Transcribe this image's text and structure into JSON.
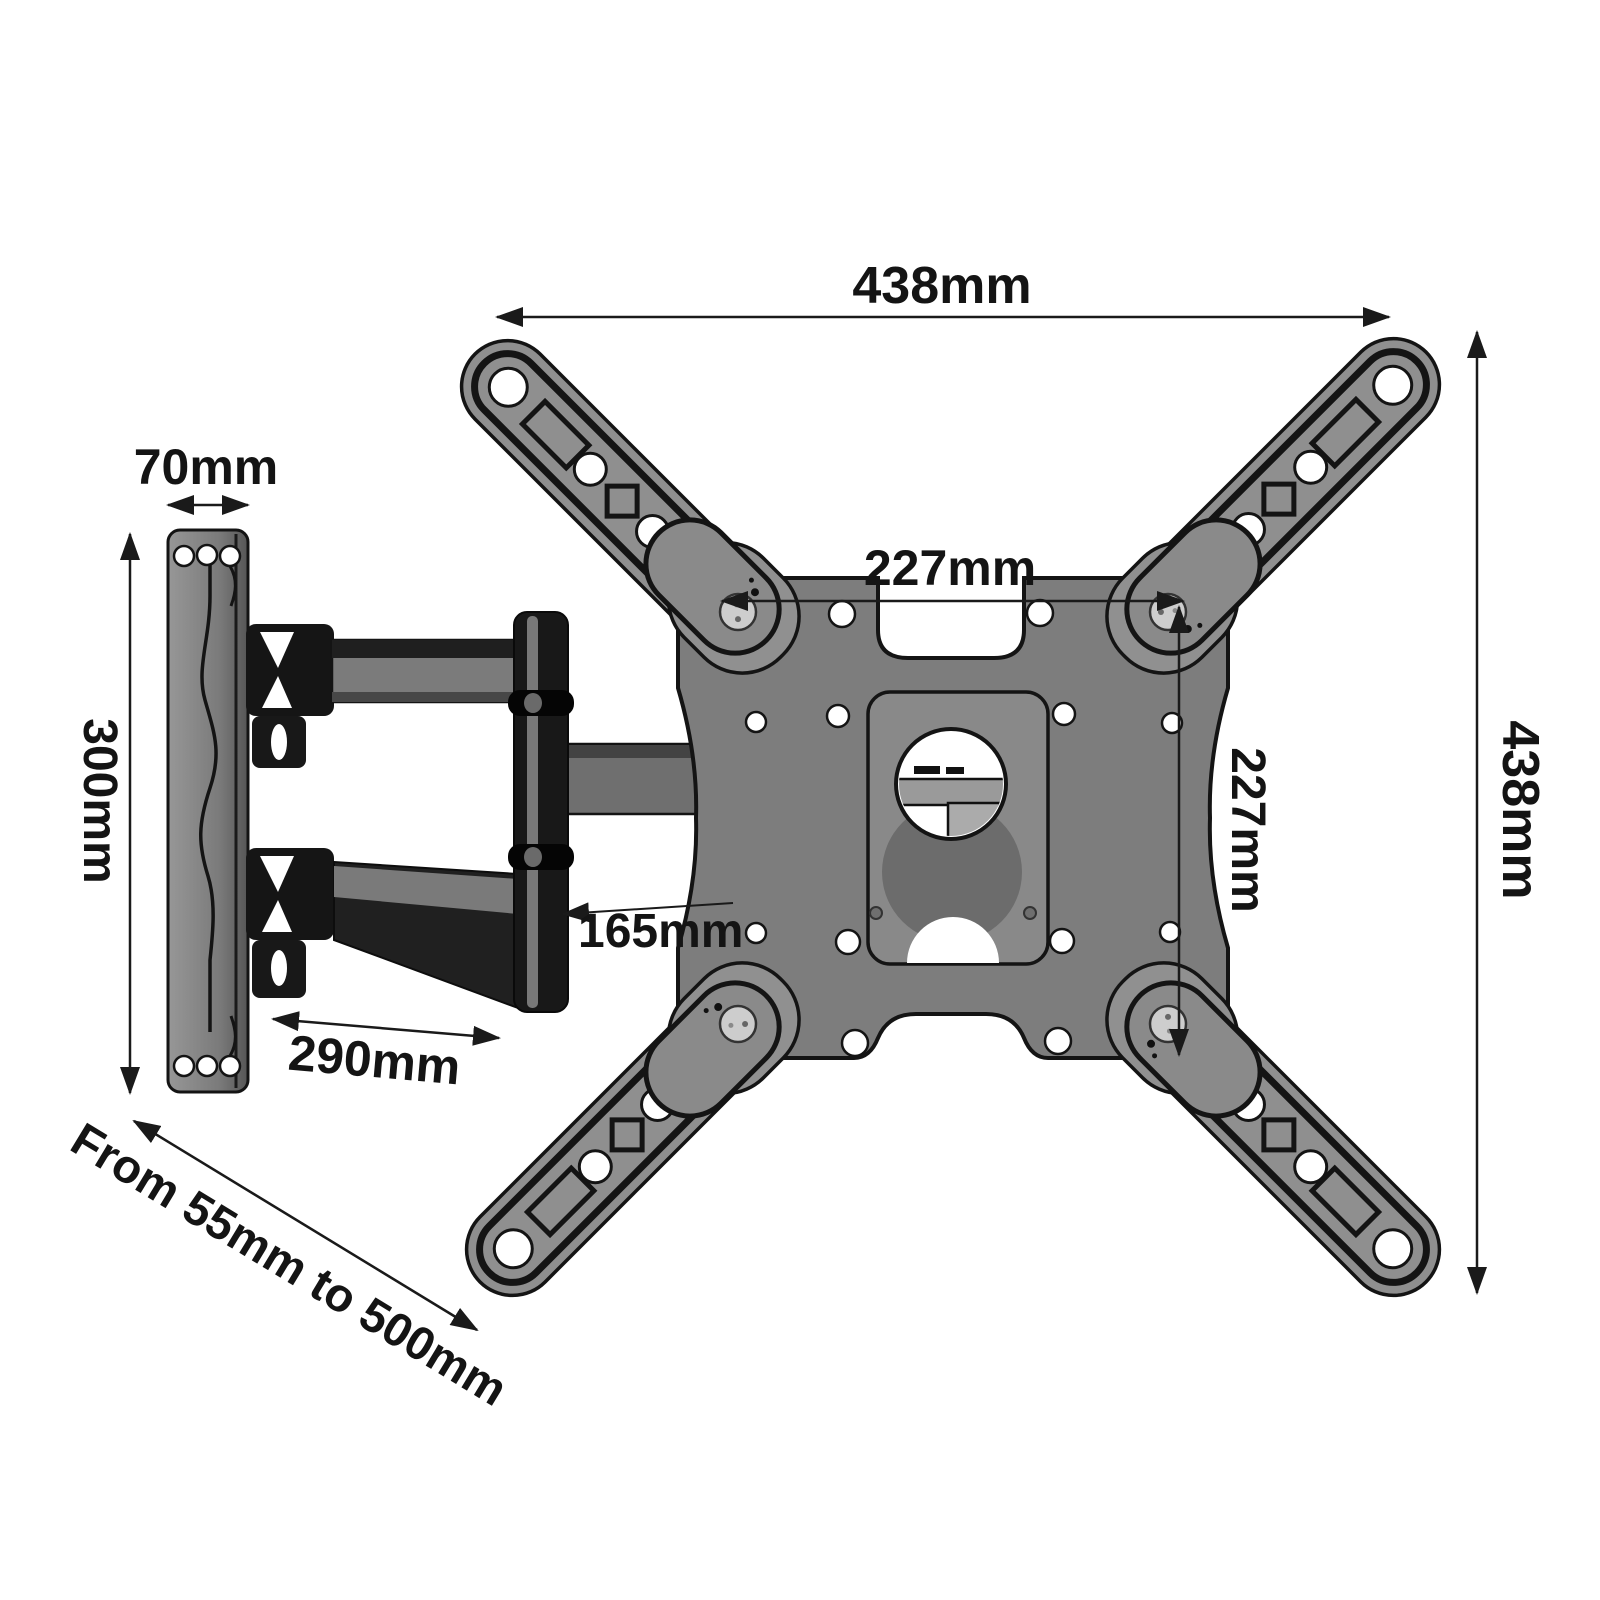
{
  "figure": {
    "description": "Articulating TV wall mount bracket dimension diagram"
  },
  "dimensions": {
    "top_width": "438mm",
    "right_height": "438mm",
    "wall_plate_width": "70mm",
    "wall_plate_height": "300mm",
    "vesa_width": "227mm",
    "vesa_height": "227mm",
    "arm_section": "165mm",
    "arm_extension": "290mm",
    "extension_range": "From 55mm to 500mm"
  },
  "colors": {
    "background": "#ffffff",
    "outline": "#141414",
    "metal_light": "#8f8f8f",
    "metal_mid": "#7d7d7d",
    "metal_dark": "#1c1c1c",
    "screw": "#cdcdcd",
    "dimension": "#1a1a1a"
  }
}
